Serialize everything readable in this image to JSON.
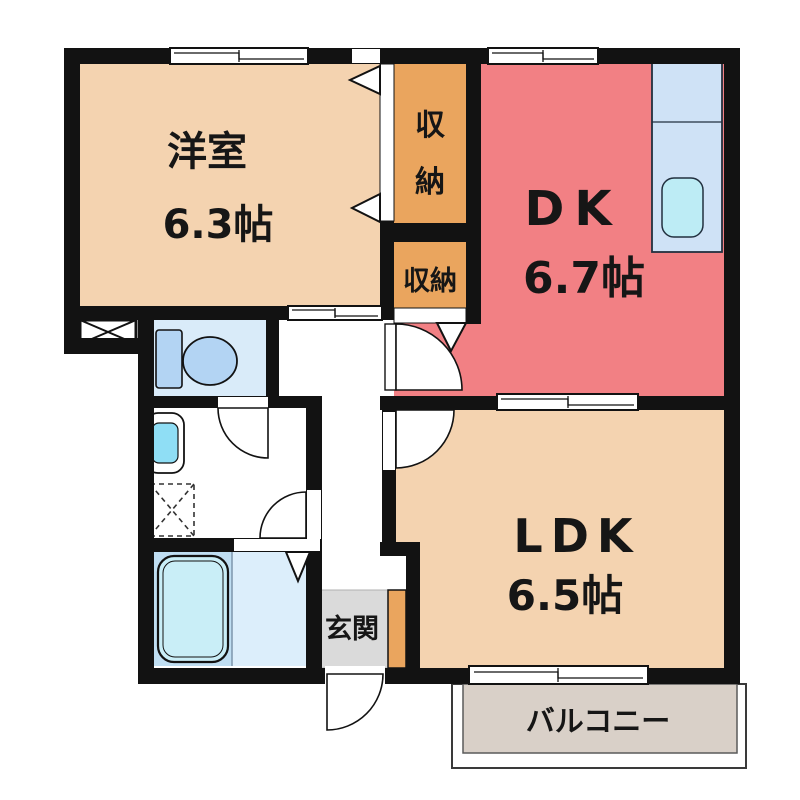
{
  "plan_title": "2DK floor plan",
  "rooms": {
    "western": {
      "label": "洋室",
      "size": "6.3帖"
    },
    "dk": {
      "label": "DK",
      "size": "6.7帖"
    },
    "ldk": {
      "label": "LDK",
      "size": "6.5帖"
    },
    "storage_upper": {
      "label": "収納",
      "char1": "収",
      "char2": "納"
    },
    "storage_lower": {
      "label": "収納"
    },
    "entrance": {
      "label": "玄関"
    },
    "balcony": {
      "label": "バルコニー"
    }
  },
  "colors": {
    "wall": "#121212",
    "room_peach": "#f4d3b0",
    "room_red": "#f28084",
    "storage_orange": "#eaa55e",
    "toilet_bg": "#d9ebf9",
    "fixture_blue": "#b3d4f3",
    "bath_bg": "#bfdef2",
    "bath_right_bg": "#dceefb",
    "tub_fill": "#c9eef7",
    "counter_fill": "#cfe2f6",
    "sink_fill": "#bdecf5",
    "basin_fill": "#8fdef5",
    "entrance_gray": "#dadada",
    "balcony_fill": "#d9d0c8"
  }
}
